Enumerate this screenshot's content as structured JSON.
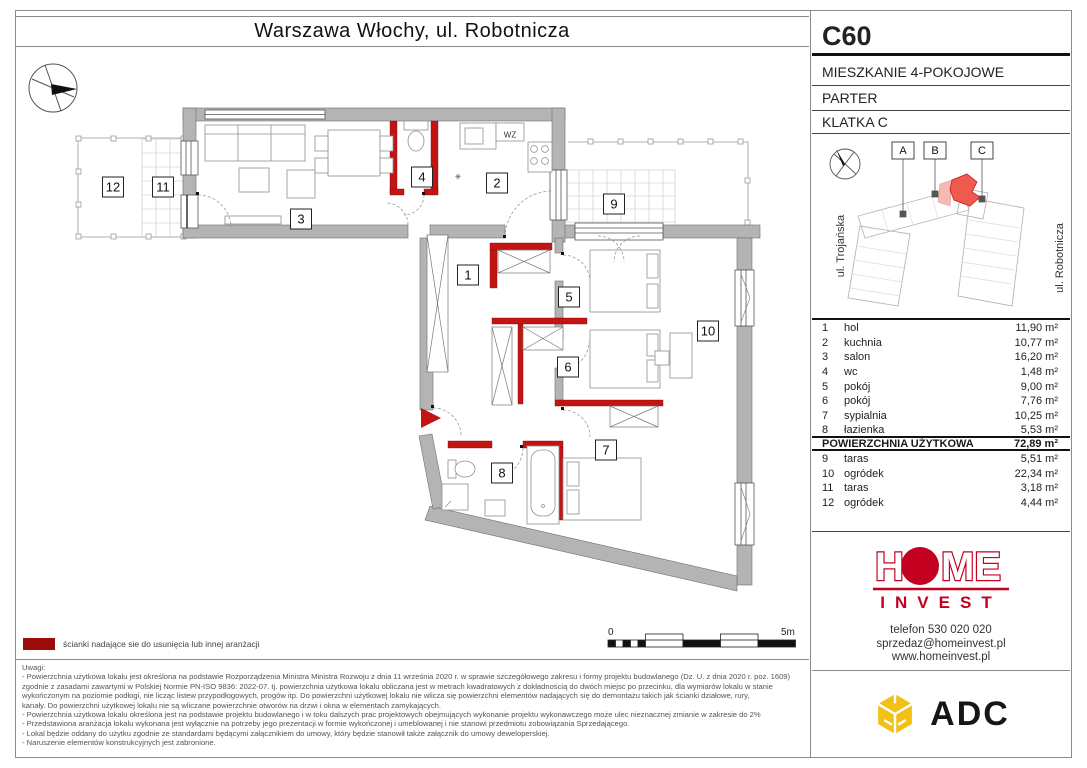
{
  "page": {
    "title": "Warszawa Włochy, ul. Robotnicza"
  },
  "unit": {
    "code": "C60",
    "type": "MIESZKANIE 4-POKOJOWE",
    "floor": "PARTER",
    "staircase": "KLATKA C"
  },
  "location": {
    "building_labels": [
      "A",
      "B",
      "C"
    ],
    "street_left": "ul. Trojańska",
    "street_right": "ul. Robotnicza"
  },
  "rooms": {
    "main": [
      {
        "no": "1",
        "name": "hol",
        "area": "11,90 m²"
      },
      {
        "no": "2",
        "name": "kuchnia",
        "area": "10,77 m²"
      },
      {
        "no": "3",
        "name": "salon",
        "area": "16,20 m²"
      },
      {
        "no": "4",
        "name": "wc",
        "area": "1,48 m²"
      },
      {
        "no": "5",
        "name": "pokój",
        "area": "9,00 m²"
      },
      {
        "no": "6",
        "name": "pokój",
        "area": "7,76 m²"
      },
      {
        "no": "7",
        "name": "sypialnia",
        "area": "10,25 m²"
      },
      {
        "no": "8",
        "name": "łazienka",
        "area": "5,53 m²"
      }
    ],
    "total_label": "POWIERZCHNIA UŻYTKOWA",
    "total_area": "72,89 m²",
    "outdoor": [
      {
        "no": "9",
        "name": "taras",
        "area": "5,51 m²"
      },
      {
        "no": "10",
        "name": "ogródek",
        "area": "22,34 m²"
      },
      {
        "no": "11",
        "name": "taras",
        "area": "3,18 m²"
      },
      {
        "no": "12",
        "name": "ogródek",
        "area": "4,44 m²"
      }
    ]
  },
  "plan": {
    "labels": [
      {
        "no": "1",
        "x": 468,
        "y": 275
      },
      {
        "no": "2",
        "x": 497,
        "y": 183
      },
      {
        "no": "3",
        "x": 301,
        "y": 219
      },
      {
        "no": "4",
        "x": 422,
        "y": 177
      },
      {
        "no": "5",
        "x": 569,
        "y": 297
      },
      {
        "no": "6",
        "x": 568,
        "y": 367
      },
      {
        "no": "7",
        "x": 606,
        "y": 450
      },
      {
        "no": "8",
        "x": 502,
        "y": 473
      },
      {
        "no": "9",
        "x": 614,
        "y": 204
      },
      {
        "no": "10",
        "x": 708,
        "y": 331
      },
      {
        "no": "11",
        "x": 163,
        "y": 187
      },
      {
        "no": "12",
        "x": 113,
        "y": 187
      }
    ],
    "annotations": [
      {
        "text": "WZ",
        "x": 510,
        "y": 135
      },
      {
        "text": "✳",
        "x": 458,
        "y": 177
      }
    ],
    "wall_color": "#b4b4b4",
    "removable_wall_color": "#c31414"
  },
  "legend": {
    "swatch_color": "#9e0b0b",
    "text": "ścianki nadające sie do usunięcia lub innej aranżacji"
  },
  "scalebar": {
    "start": "0",
    "end": "5m"
  },
  "developer": {
    "logo_word": "HOME",
    "logo_sub": "INVEST",
    "brand_color": "#c3001f",
    "phone": "telefon 530 020 020",
    "email": "sprzedaz@homeinvest.pl",
    "website": "www.homeinvest.pl"
  },
  "agency": {
    "name": "ADC",
    "icon_color": "#f2c115"
  },
  "disclaimer": {
    "heading": "Uwagi:",
    "lines": [
      "- Powierzchnia użytkowa lokalu jest określona na podstawie Rozporządzenia Ministra Ministra Rozwoju z dnia 11 września 2020 r. w sprawie szczegółowego zakresu i formy projektu budowlanego (Dz. U. z dnia 2020 r. poz. 1609)",
      "zgodnie z zasadami zawartymi w Polskiej Normie PN-ISO 9836: 2022-07. tj. powierzchnia użytkowa lokalu obliczana jest w metrach kwadratowych z dokładnością do dwóch miejsc po przecinku, dla wymiarów lokalu w stanie",
      "wykończonym na poziomie podłogi, nie licząc listew przypodłogowych, progów itp. Do powierzchni użytkowej lokalu nie wlicza się powierzchni elementów nadających się do demontażu takich jak ścianki działowe, rury,",
      "kanały. Do powierzchni użytkowej lokalu nie są wliczane powierzchnie otworów na drzwi i okna w elementach zamykających.",
      "- Powierzchnia użytkowa lokalu określona jest na podstawie projektu budowlanego i w toku dalszych prac projektowych obejmujących wykonanie projektu wykonawczego może ulec nieznacznej zmianie w zakresie do 2%",
      "- Przedstawiona aranżacja lokalu wykonana jest wyłącznie na potrzeby jego prezentacji w formie wykończonej i umeblowanej i nie stanowi przedmiotu zobowiązania Sprzedającego.",
      "- Lokal będzie oddany do użytku zgodnie ze standardami będącymi załącznikiem do umowy, który będzie stanowił także załącznik do umowy deweloperskiej.",
      "- Naruszenie elementów konstrukcyjnych jest zabronione."
    ]
  }
}
